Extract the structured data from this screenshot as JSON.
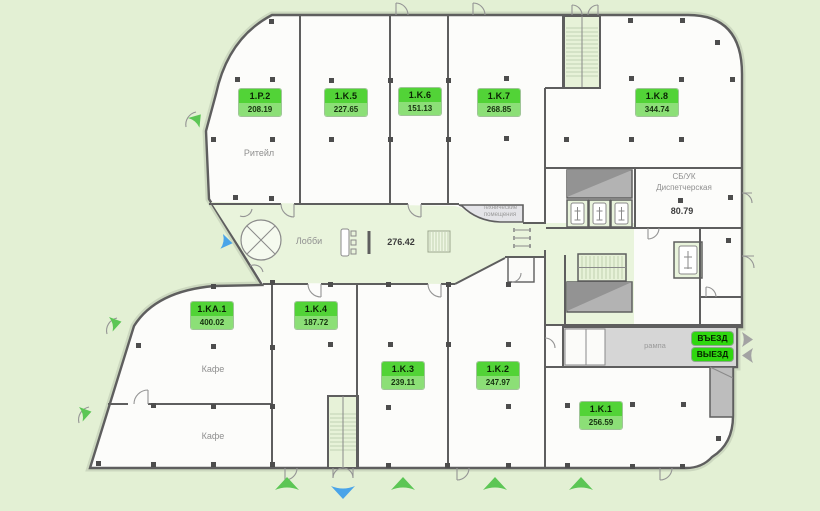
{
  "plan": {
    "type": "floor-plan",
    "rooms": [
      {
        "code": "1.P.2",
        "area": "208.19"
      },
      {
        "code": "1.K.5",
        "area": "227.65"
      },
      {
        "code": "1.K.6",
        "area": "151.13"
      },
      {
        "code": "1.K.7",
        "area": "268.85"
      },
      {
        "code": "1.K.8",
        "area": "344.74"
      },
      {
        "code": "1.KA.1",
        "area": "400.02"
      },
      {
        "code": "1.K.4",
        "area": "187.72"
      },
      {
        "code": "1.K.3",
        "area": "239.11"
      },
      {
        "code": "1.K.2",
        "area": "247.97"
      },
      {
        "code": "1.K.1",
        "area": "256.59"
      }
    ],
    "texts": {
      "retail": "Ритейл",
      "lobby": "Лобби",
      "lobby_area": "276.42",
      "cafe_upper": "Кафе",
      "cafe_lower": "Кафе",
      "dispatch_line1": "СБ/УК",
      "dispatch_line2": "Диспетчерская",
      "dispatch_area": "80.79",
      "ramp": "рампа",
      "tech_line1": "технические",
      "tech_line2": "помещения"
    },
    "badges": {
      "entry": "ВЪЕЗД",
      "exit": "ВЫЕЗД"
    },
    "colors": {
      "background": "#e3f0d4",
      "room_fill": "#fcfcfa",
      "zone_green": "#e9f4dc",
      "label_top": "#52d337",
      "label_bottom": "#8cdf77",
      "badge_green": "#2fd70f",
      "arrow_green": "#5cc655",
      "arrow_blue": "#49a4e9",
      "arrow_gray": "#a3a3a3",
      "wall": "#5e5e5e",
      "shaft_gray": "#b3b3b3",
      "ramp_gray": "#d6d6d6"
    }
  }
}
